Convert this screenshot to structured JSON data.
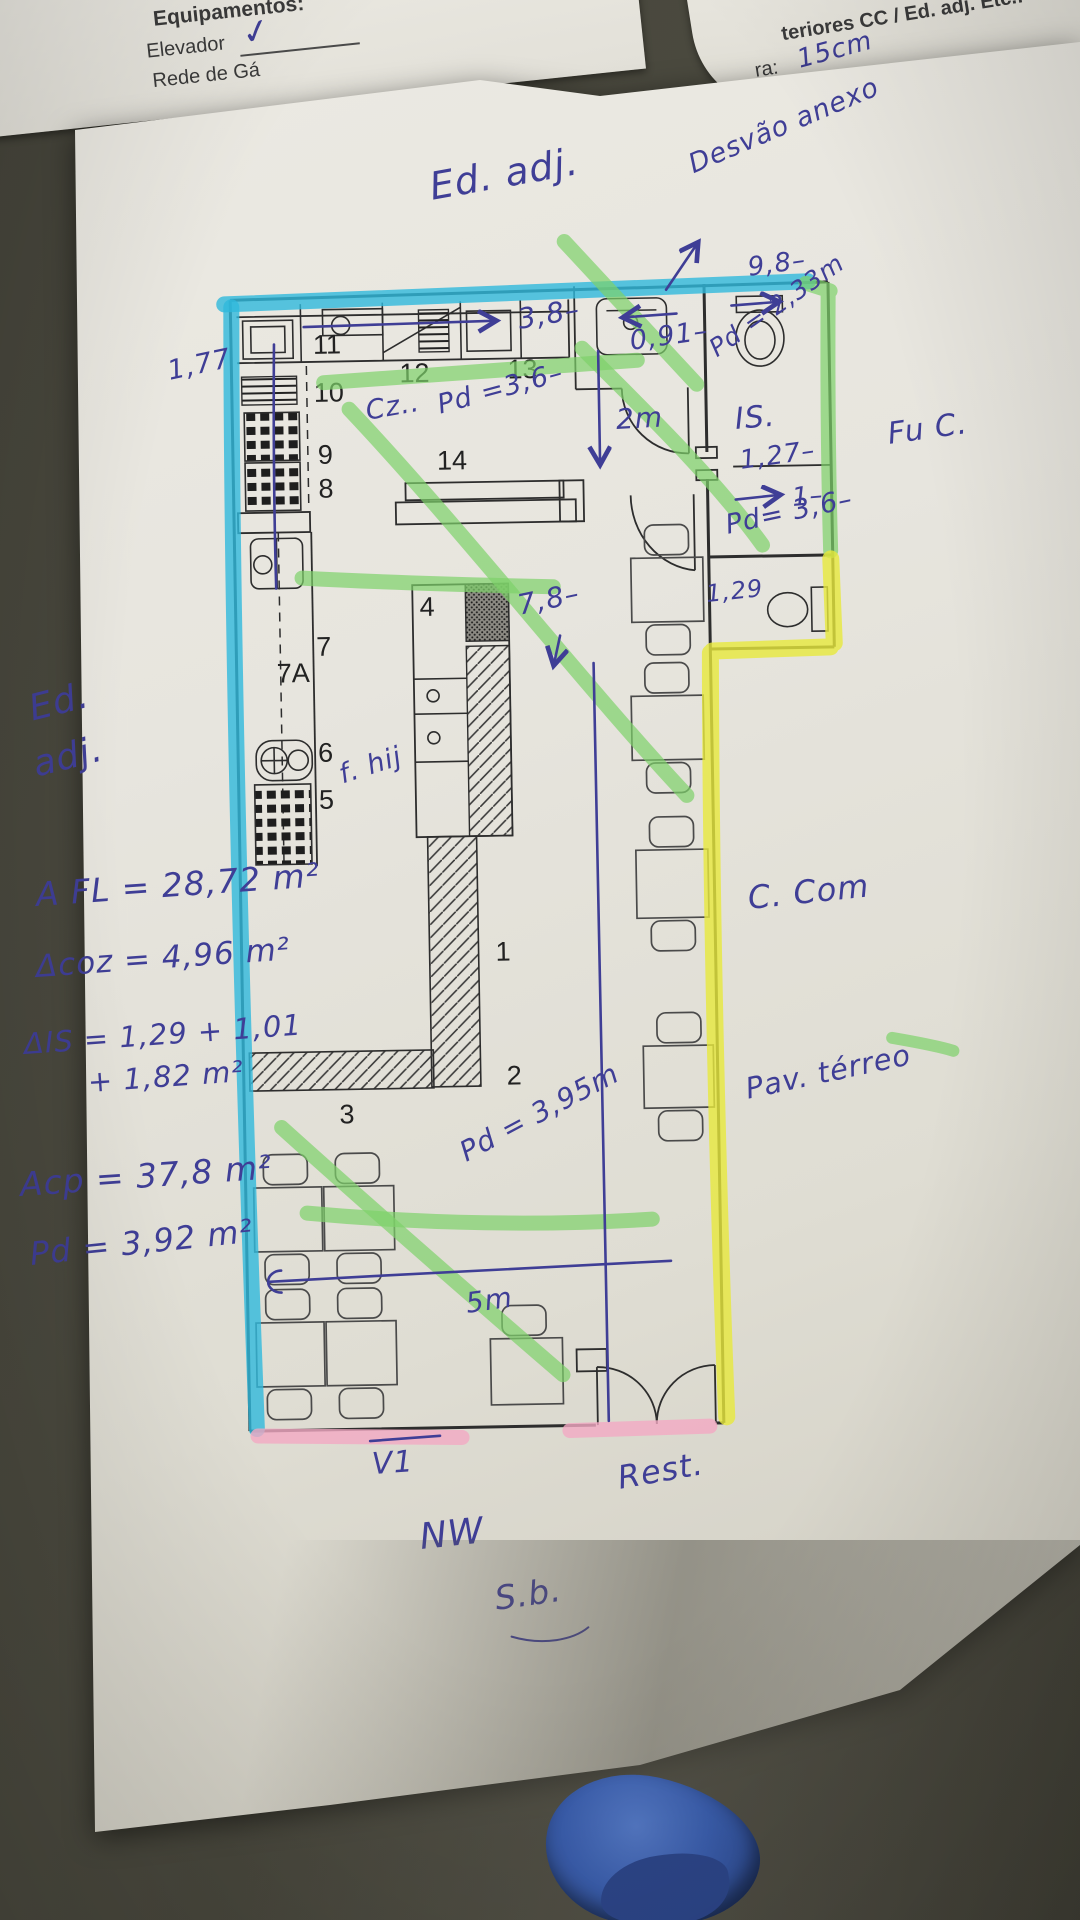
{
  "colors": {
    "pen_ink": "#3f3e96",
    "highlighter_cyan": "#2fb9dc",
    "highlighter_green": "#7ed169",
    "highlighter_yellow": "#e7e93c",
    "highlighter_pink": "#f3a9c3",
    "paper": "#e7e5de",
    "background": "#4b4a3f"
  },
  "top_sheets": {
    "left": {
      "handwritten_note": "25 cm",
      "heading": "Equipamentos:",
      "item1": "Elevador",
      "item1_mark": "✓",
      "item2": "Rede de Gá"
    },
    "right": {
      "heading": "teriores CC / Ed. adj. Etc.:",
      "field_label": "ra:",
      "field_value": "15cm"
    }
  },
  "plan_labels": {
    "n1": "1",
    "n2": "2",
    "n3": "3",
    "n4": "4",
    "n5": "5",
    "n6": "6",
    "n7": "7",
    "n7a": "7A",
    "n8": "8",
    "n9": "9",
    "n10": "10",
    "n11": "11",
    "n12": "12",
    "n13": "13",
    "n14": "14"
  },
  "annotations": {
    "ed_adj_top": "Ed. adj.",
    "desvao_anexo": "Desvão anexo",
    "dim_9_8": "9,8–",
    "pd_2_33": "Pd = 2,33m",
    "is_room": "IS.",
    "dim_1_27": "1,27–",
    "dim_1": "1–",
    "pd_3_6_right": "Pd= 3,6–",
    "dim_1_29": "1,29",
    "dim_0_91": "0,91–",
    "dim_3_8": "3,8–",
    "dim_2m": "2m",
    "dim_1_77": "1,77",
    "cz": "Cz..",
    "pd_3_6_kitchen": "Pd =3,6–",
    "dim_7_8": "7,8–",
    "f_hij": "f. hij",
    "ed_left_line1": "Ed.",
    "ed_left_line2": "adj.",
    "area_fl": "A FL = 28,72 m²",
    "area_coz": "Δcoz = 4,96 m²",
    "area_is_line1": "ΔIS = 1,29 + 1,01",
    "area_is_line2": "+ 1,82 m²",
    "area_cp": "Acp =  37,8 m²",
    "pd_3_92": "Pd = 3,92 m²",
    "c_com": "C. Com",
    "pav_terreo": "Pav. térreo",
    "pd_3_95": "Pd = 3,95m",
    "dim_5m": "5m",
    "v1": "V1",
    "nw": "NW",
    "sb": "S.b.",
    "rest": "Rest.",
    "fu_c": "Fu C."
  }
}
